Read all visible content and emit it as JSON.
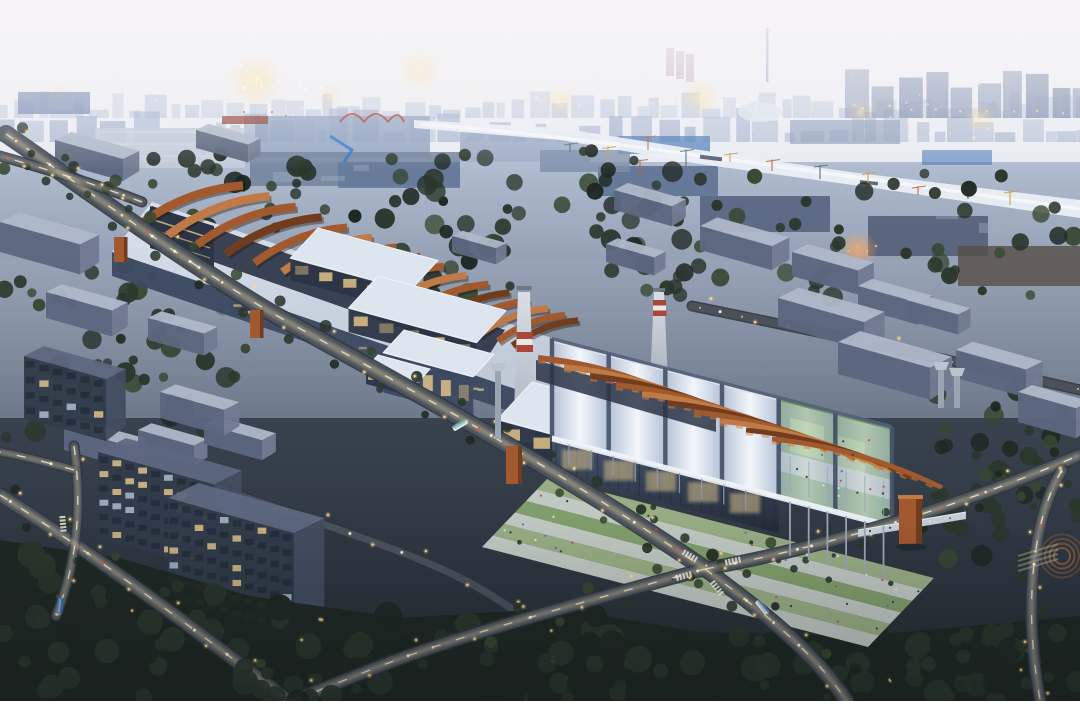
{
  "scene": {
    "type": "architectural-aerial-rendering",
    "time_of_day": "dusk",
    "description": "Aerial dusk rendering of a riverside industrial district converted into an exhibition campus: a long factory hall crowned with corten-steel roof fins, a vaulted translucent exhibition center with terraced gardens and open colonnade, corten wayfinding towers, striped chimneys, tree-lined lit roads with traffic, office blocks, a crane-lined canal and a glowing city skyline beyond."
  },
  "palette": {
    "white": "#ffffff",
    "water": "#eaeff5",
    "skyline-far": "#bdc9dd",
    "skyline-near": "#9cadca",
    "city-block": "#7a8bab",
    "crane-yellow": "#c8a04a",
    "crane-orange": "#b96a3c",
    "red-steel": "#b04038",
    "blue-roof": "#4a78b6",
    "tree-dark": "#1e2822",
    "tree-mid": "#2a372c",
    "tree-light": "#374832",
    "tree-teal": "#578275",
    "box-top": "#aeb8c9",
    "box-front": "#5b677e",
    "box-side": "#707b92",
    "tower-top": "#5d6880",
    "tower-front": "#313b4a",
    "tower-side": "#424d60",
    "window-warm": "#dfc286",
    "window-cool": "#a9bccf",
    "glass-dark": "#2b3546",
    "glass-mid": "#3c4a61",
    "shed-roof": "#dde5ef",
    "vault-light": "#eef3f9",
    "rib": "#46536a",
    "courtyard": "#6a9160",
    "court-green": "#8fb571",
    "terrace-green": "#85a36e",
    "terrace-green2": "#9db387",
    "terrace-path": "#c7d0c8",
    "corten": "#a2592e",
    "corten-light": "#bf7a45",
    "corten-dark": "#713d1e",
    "stripe-red": "#a8473a",
    "stripe-white": "#e9e6e3",
    "road": "#4a515b",
    "road-edge": "#31373f",
    "lamp-glow": "#ffd98a",
    "people": "#2c3746"
  }
}
